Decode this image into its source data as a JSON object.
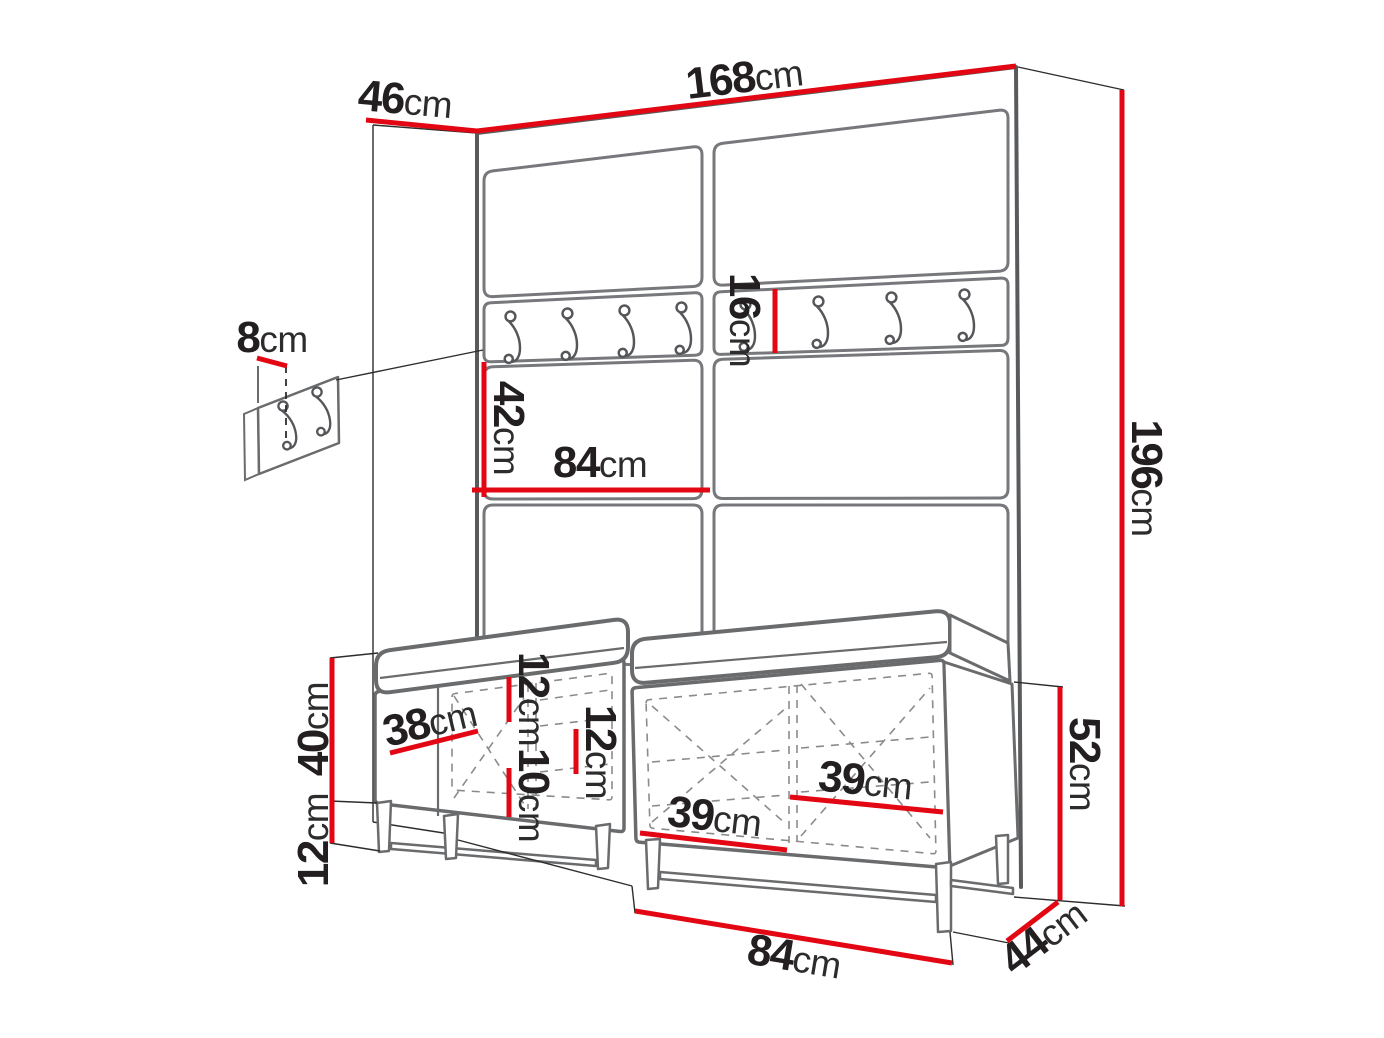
{
  "diagram": {
    "type": "furniture-dimension-drawing",
    "subject": "hallway wardrobe set with upholstered wall panels, coat hook rails and two shoe bench cabinets",
    "unit": "cm",
    "colors": {
      "dimension_line": "#e30613",
      "furniture_line": "#77787b",
      "text": "#231f20"
    },
    "icons": {
      "coat_hook": "j-shaped-wall-hook",
      "mini_panel_hook": "j-shaped-wall-hook"
    },
    "dims": {
      "total_width": {
        "num": "168",
        "unit": "cm"
      },
      "total_depth": {
        "num": "46",
        "unit": "cm"
      },
      "total_height": {
        "num": "196",
        "unit": "cm"
      },
      "mini_panel_offset": {
        "num": "8",
        "unit": "cm"
      },
      "rail_drop": {
        "num": "42",
        "unit": "cm"
      },
      "panel_half_width": {
        "num": "84",
        "unit": "cm"
      },
      "rail_height": {
        "num": "16",
        "unit": "cm"
      },
      "bench_body_height": {
        "num": "40",
        "unit": "cm"
      },
      "leg_height": {
        "num": "12",
        "unit": "cm"
      },
      "compartment_width": {
        "num": "38",
        "unit": "cm"
      },
      "shelf_gap_top": {
        "num": "12",
        "unit": "cm"
      },
      "shelf_gap_mid": {
        "num": "12",
        "unit": "cm"
      },
      "shelf_gap_bottom": {
        "num": "10",
        "unit": "cm"
      },
      "shelf_width_left": {
        "num": "39",
        "unit": "cm"
      },
      "shelf_width_right": {
        "num": "39",
        "unit": "cm"
      },
      "bench_height": {
        "num": "52",
        "unit": "cm"
      },
      "bench_depth": {
        "num": "44",
        "unit": "cm"
      },
      "bench_width": {
        "num": "84",
        "unit": "cm"
      }
    }
  }
}
